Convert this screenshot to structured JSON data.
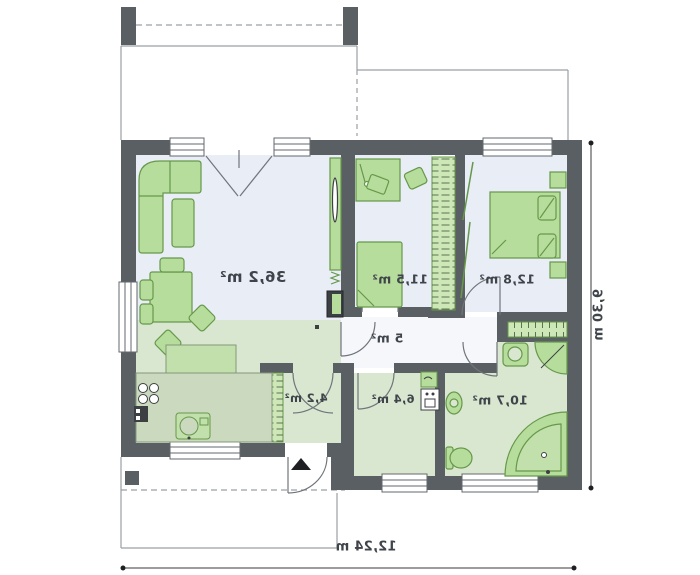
{
  "plan": {
    "mirrored": true,
    "rooms": [
      {
        "id": "living-room",
        "area_label": "36,2 m²"
      },
      {
        "id": "room-11-5",
        "area_label": "11,5 m²"
      },
      {
        "id": "bedroom-12-8",
        "area_label": "12,8 m²"
      },
      {
        "id": "corridor",
        "area_label": "5 m²"
      },
      {
        "id": "entry-hall",
        "area_label": "4,2 m²"
      },
      {
        "id": "utility-room",
        "area_label": "6,4 m²"
      },
      {
        "id": "bathroom",
        "area_label": "10,7 m²"
      }
    ],
    "dimensions": {
      "width_label": "12,24 m",
      "height_label": "9,30 m"
    },
    "colors": {
      "wall": "#5a5f64",
      "floor_blue": "#e8edf6",
      "floor_green": "#d9e7d0",
      "corridor_floor": "#f5f7fb",
      "furniture_fill": "#b7dd9d",
      "furniture_stroke": "#66984a",
      "counter_fill": "#cbd9bf",
      "outline_thin": "#9ba0a5",
      "text": "#3f444a"
    }
  }
}
